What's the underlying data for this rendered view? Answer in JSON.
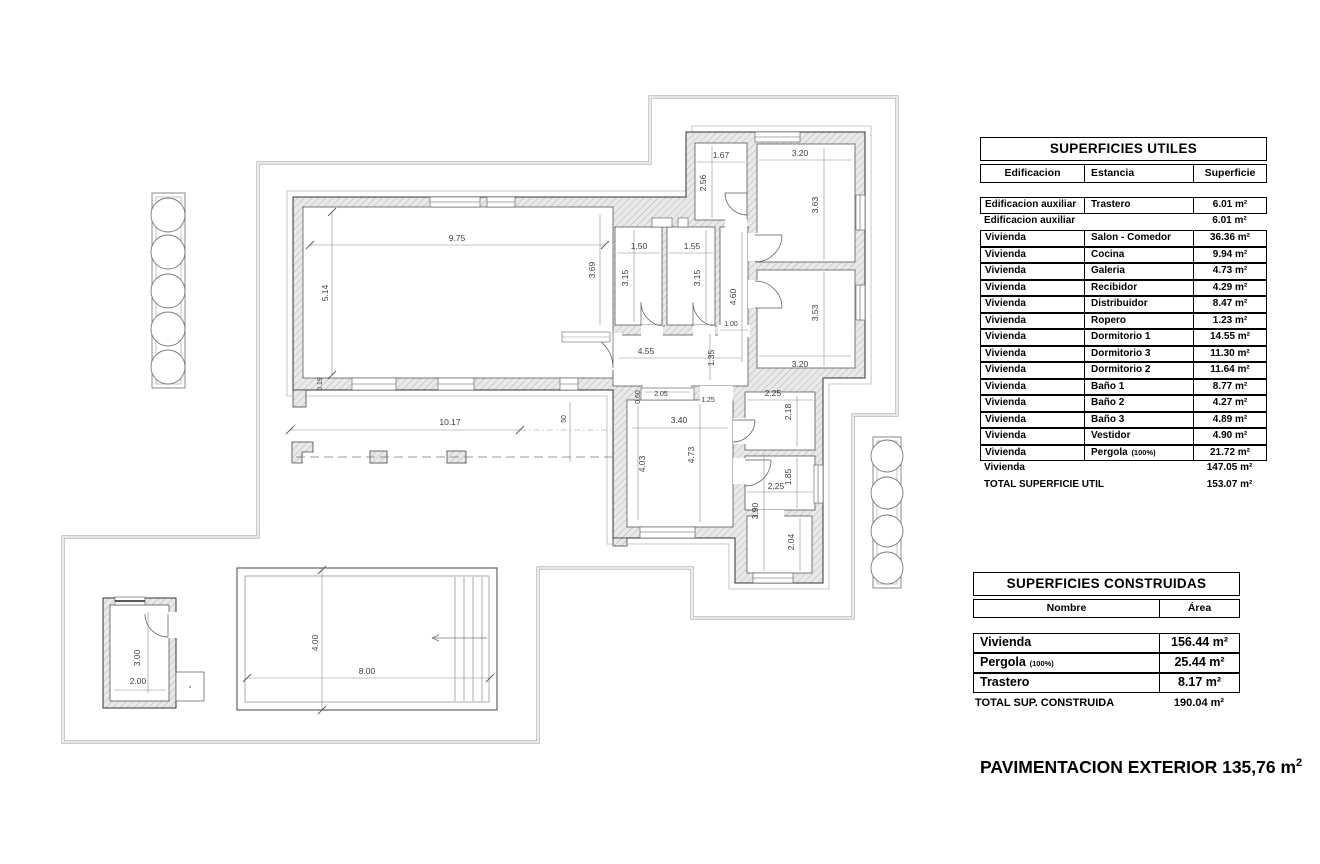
{
  "plan": {
    "dimension_labels": [
      {
        "text": "9.75",
        "x": 457,
        "y": 241,
        "v": false
      },
      {
        "text": "5.14",
        "x": 328,
        "y": 293,
        "v": true
      },
      {
        "text": "0.19",
        "x": 322,
        "y": 384,
        "v": true,
        "f": 7
      },
      {
        "text": "3.69",
        "x": 595,
        "y": 270,
        "v": true
      },
      {
        "text": "1.50",
        "x": 639,
        "y": 249,
        "v": false
      },
      {
        "text": "3.15",
        "x": 628,
        "y": 278,
        "v": true
      },
      {
        "text": "1.55",
        "x": 692,
        "y": 249,
        "v": false
      },
      {
        "text": "3.15",
        "x": 700,
        "y": 278,
        "v": true
      },
      {
        "text": "1.67",
        "x": 721,
        "y": 158,
        "v": false
      },
      {
        "text": "2.56",
        "x": 706,
        "y": 183,
        "v": true
      },
      {
        "text": "3.20",
        "x": 800,
        "y": 156,
        "v": false
      },
      {
        "text": "3.63",
        "x": 818,
        "y": 205,
        "v": true
      },
      {
        "text": "4.60",
        "x": 736,
        "y": 297,
        "v": true
      },
      {
        "text": "1.00",
        "x": 731,
        "y": 326,
        "v": false,
        "f": 7
      },
      {
        "text": "3.53",
        "x": 818,
        "y": 313,
        "v": true
      },
      {
        "text": "3.20",
        "x": 800,
        "y": 367,
        "v": false
      },
      {
        "text": "4.55",
        "x": 646,
        "y": 354,
        "v": false
      },
      {
        "text": "1.35",
        "x": 714,
        "y": 358,
        "v": true
      },
      {
        "text": "2.05",
        "x": 661,
        "y": 396,
        "v": false,
        "f": 7
      },
      {
        "text": "0.60",
        "x": 640,
        "y": 397,
        "v": true,
        "f": 7
      },
      {
        "text": "1.25",
        "x": 708,
        "y": 402,
        "v": false,
        "f": 7
      },
      {
        "text": "2.25",
        "x": 773,
        "y": 396,
        "v": false
      },
      {
        "text": "2.18",
        "x": 791,
        "y": 412,
        "v": true
      },
      {
        "text": "3.40",
        "x": 679,
        "y": 423,
        "v": false
      },
      {
        "text": "10.17",
        "x": 450,
        "y": 425,
        "v": false
      },
      {
        "text": "50",
        "x": 566,
        "y": 419,
        "v": true,
        "f": 7
      },
      {
        "text": "4.03",
        "x": 645,
        "y": 464,
        "v": true
      },
      {
        "text": "4.73",
        "x": 694,
        "y": 455,
        "v": true
      },
      {
        "text": "2.25",
        "x": 776,
        "y": 489,
        "v": false
      },
      {
        "text": "1.85",
        "x": 791,
        "y": 477,
        "v": true
      },
      {
        "text": "3.90",
        "x": 758,
        "y": 511,
        "v": true
      },
      {
        "text": "2.04",
        "x": 794,
        "y": 542,
        "v": true
      },
      {
        "text": "4.00",
        "x": 318,
        "y": 643,
        "v": true
      },
      {
        "text": "8.00",
        "x": 367,
        "y": 674,
        "v": false
      },
      {
        "text": "3.00",
        "x": 140,
        "y": 658,
        "v": true
      },
      {
        "text": "2.00",
        "x": 138,
        "y": 684,
        "v": false
      }
    ]
  },
  "tables": {
    "utiles": {
      "title": "SUPERFICIES UTILES",
      "columns": [
        "Edificacion",
        "Estancia",
        "Superficie"
      ],
      "rows": [
        {
          "c1": "Edificacion auxiliar",
          "c2": "Trastero",
          "c3": "6.01 m²",
          "boxed": true
        },
        {
          "c1": "Edificacion auxiliar",
          "c2": "",
          "c3": "6.01 m²",
          "boxed": false
        },
        {
          "c1": "Vivienda",
          "c2": "Salon - Comedor",
          "c3": "36.36 m²",
          "boxed": true
        },
        {
          "c1": "Vivienda",
          "c2": "Cocina",
          "c3": "9.94 m²",
          "boxed": true
        },
        {
          "c1": "Vivienda",
          "c2": "Galeria",
          "c3": "4.73 m²",
          "boxed": true
        },
        {
          "c1": "Vivienda",
          "c2": "Recibidor",
          "c3": "4.29 m²",
          "boxed": true
        },
        {
          "c1": "Vivienda",
          "c2": "Distribuidor",
          "c3": "8.47 m²",
          "boxed": true
        },
        {
          "c1": "Vivienda",
          "c2": "Ropero",
          "c3": "1.23 m²",
          "boxed": true
        },
        {
          "c1": "Vivienda",
          "c2": "Dormitorio 1",
          "c3": "14.55 m²",
          "boxed": true
        },
        {
          "c1": "Vivienda",
          "c2": "Dormitorio 3",
          "c3": "11.30 m²",
          "boxed": true
        },
        {
          "c1": "Vivienda",
          "c2": "Dormitorio 2",
          "c3": "11.64 m²",
          "boxed": true
        },
        {
          "c1": "Vivienda",
          "c2": "Baño 1",
          "c3": "8.77 m²",
          "boxed": true
        },
        {
          "c1": "Vivienda",
          "c2": "Baño 2",
          "c3": "4.27 m²",
          "boxed": true
        },
        {
          "c1": "Vivienda",
          "c2": "Baño 3",
          "c3": "4.89 m²",
          "boxed": true
        },
        {
          "c1": "Vivienda",
          "c2": "Vestidor",
          "c3": "4.90 m²",
          "boxed": true
        },
        {
          "c1": "Vivienda",
          "c2": "Pergola",
          "note": "(100%)",
          "c3": "21.72 m²",
          "boxed": true
        },
        {
          "c1": "Vivienda",
          "c2": "",
          "c3": "147.05 m²",
          "boxed": false
        },
        {
          "c1": "TOTAL SUPERFICIE UTIL",
          "c2": "",
          "c3": "153.07 m²",
          "boxed": false
        }
      ]
    },
    "construidas": {
      "title": "SUPERFICIES CONSTRUIDAS",
      "columns": [
        "Nombre",
        "Área"
      ],
      "rows": [
        {
          "n": "Vivienda",
          "a": "156.44 m²"
        },
        {
          "n": "Pergola",
          "note": "(100%)",
          "a": "25.44 m²"
        },
        {
          "n": "Trastero",
          "a": "8.17 m²"
        }
      ],
      "total_label": "TOTAL SUP. CONSTRUIDA",
      "total_value": "190.04 m²"
    }
  },
  "footer": {
    "text": "PAVIMENTACION EXTERIOR 135,76 m",
    "sup": "2"
  }
}
